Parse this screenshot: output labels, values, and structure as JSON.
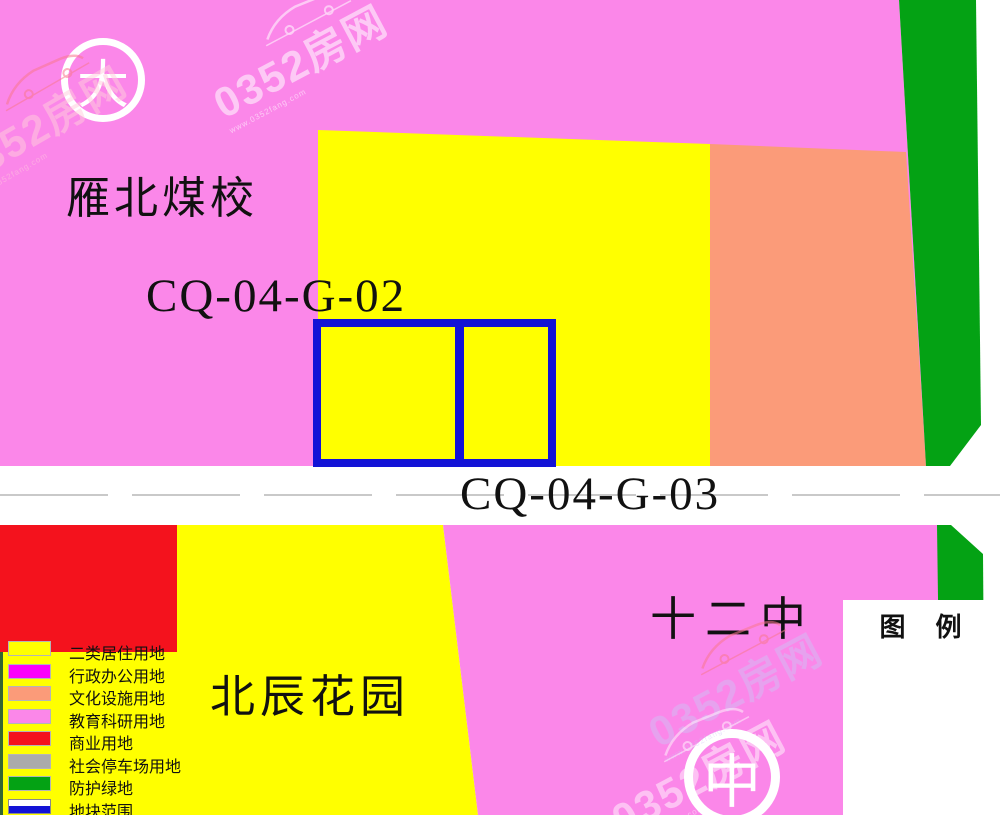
{
  "map": {
    "area_labels": {
      "yanbei_coal_school": "雁北煤校",
      "plot_code_top": "CQ-04-G-02",
      "plot_code_bottom": "CQ-04-G-03",
      "no12_middle_school": "十二中",
      "beichen_garden": "北辰花园"
    },
    "circle_markers": {
      "top_left": "大",
      "bottom_right": "中"
    },
    "regions": [
      {
        "id": "education-top",
        "land_use": "教育科研用地",
        "color_key": "pink"
      },
      {
        "id": "residential-top",
        "land_use": "二类居住用地",
        "color_key": "yellow"
      },
      {
        "id": "cultural",
        "land_use": "文化设施用地",
        "color_key": "salmon"
      },
      {
        "id": "green-buffer-top",
        "land_use": "防护绿地",
        "color_key": "green"
      },
      {
        "id": "commercial",
        "land_use": "商业用地",
        "color_key": "red"
      },
      {
        "id": "residential-bottom",
        "land_use": "二类居住用地",
        "color_key": "yellow"
      },
      {
        "id": "education-bottom",
        "land_use": "教育科研用地",
        "color_key": "pink"
      },
      {
        "id": "green-buffer-bottom",
        "land_use": "防护绿地",
        "color_key": "green"
      },
      {
        "id": "plot-boundary",
        "land_use": "地块范围",
        "color_key": "blue"
      }
    ]
  },
  "legend": {
    "title": "图　例",
    "items": [
      {
        "label": "二类居住用地",
        "color_key": "yellow",
        "swatch": "fill"
      },
      {
        "label": "行政办公用地",
        "color_key": "magenta",
        "swatch": "fill"
      },
      {
        "label": "文化设施用地",
        "color_key": "salmon",
        "swatch": "fill"
      },
      {
        "label": "教育科研用地",
        "color_key": "pink",
        "swatch": "fill"
      },
      {
        "label": "商业用地",
        "color_key": "red",
        "swatch": "fill"
      },
      {
        "label": "社会停车场用地",
        "color_key": "gray",
        "swatch": "fill"
      },
      {
        "label": "防护绿地",
        "color_key": "green",
        "swatch": "fill"
      },
      {
        "label": "地块范围",
        "color_key": "blue",
        "swatch": "outline"
      }
    ]
  },
  "watermark": {
    "brand": "0352房网",
    "url_text": "www.0352fang.com"
  },
  "colors": {
    "pink": "#fb87e9",
    "yellow": "#ffff00",
    "salmon": "#fb9b79",
    "red": "#f4121d",
    "green": "#04a214",
    "magenta": "#fb00fb",
    "gray": "#ababab",
    "blue": "#1313d6",
    "dark_green_edge": "#336633",
    "road_dash": "#c9c9c9",
    "legend_bg": "#ffffff",
    "road_bg": "#ffffff",
    "text": "#111111"
  }
}
